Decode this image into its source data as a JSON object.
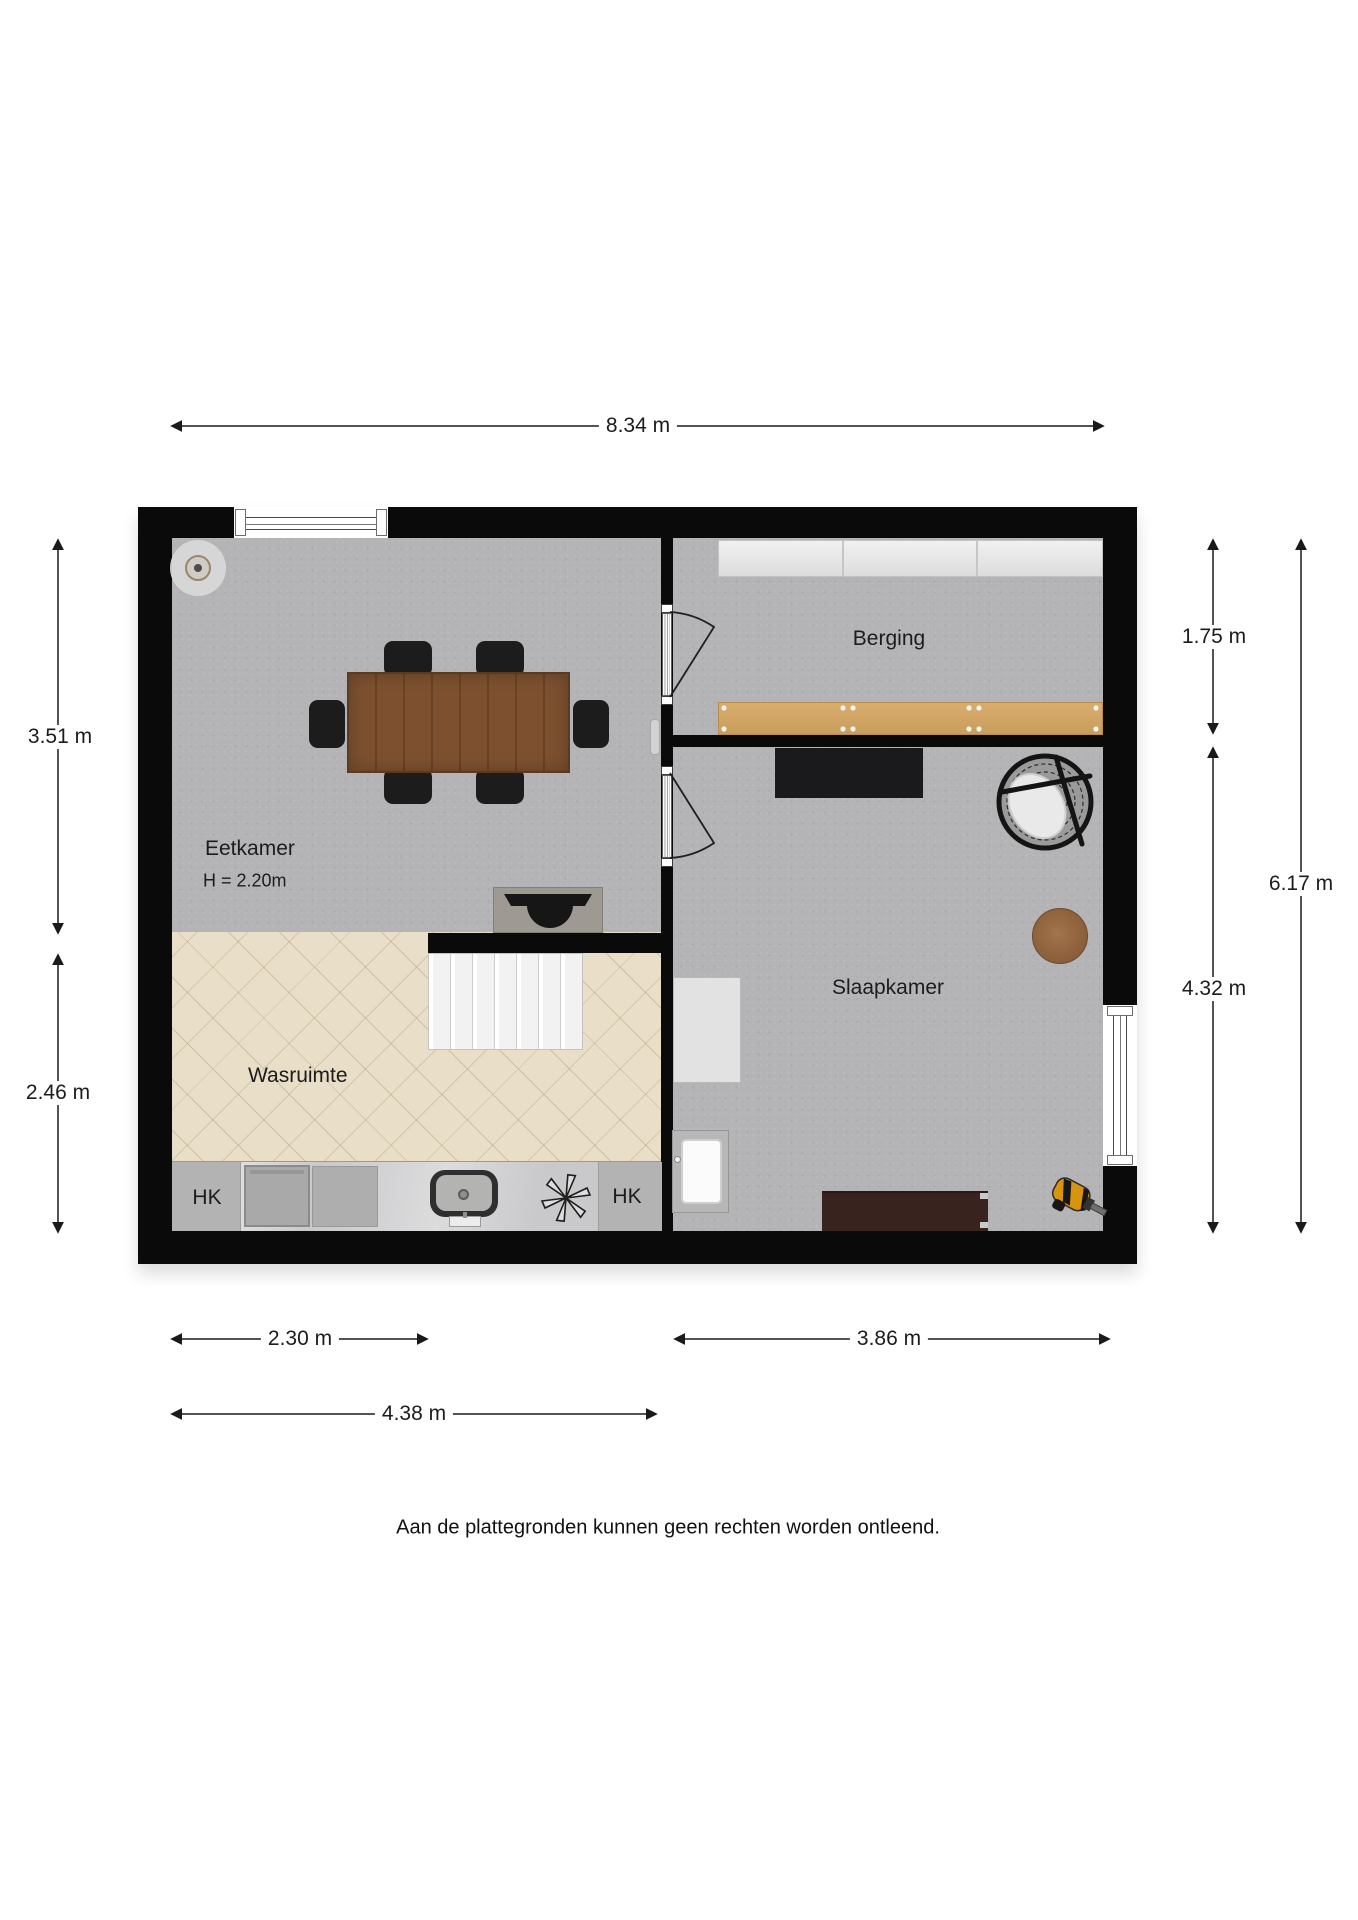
{
  "plan": {
    "rooms": {
      "eetkamer": {
        "label": "Eetkamer",
        "height_note": "H = 2.20m"
      },
      "wasruimte": {
        "label": "Wasruimte"
      },
      "berging": {
        "label": "Berging"
      },
      "slaapkamer": {
        "label": "Slaapkamer"
      }
    },
    "closets": {
      "left": "HK",
      "right": "HK"
    }
  },
  "dimensions": {
    "width_total": "8.34 m",
    "left_upper": "3.51 m",
    "left_lower": "2.46 m",
    "right_upper": "1.75 m",
    "right_lower": "4.32 m",
    "right_total": "6.17 m",
    "bottom_inner_left": "2.30 m",
    "bottom_inner_right": "3.86 m",
    "bottom_outer": "4.38 m"
  },
  "footer": {
    "disclaimer": "Aan de plattegronden kunnen geen rechten worden ontleend."
  },
  "colors": {
    "wall": "#0a0a0a",
    "floor_gray": "#b4b4b6",
    "floor_laundry": "#e9dec8",
    "table_wood": "#7d5130",
    "workbench_wood": "#d2a368",
    "drill_accent": "#d8930f"
  }
}
